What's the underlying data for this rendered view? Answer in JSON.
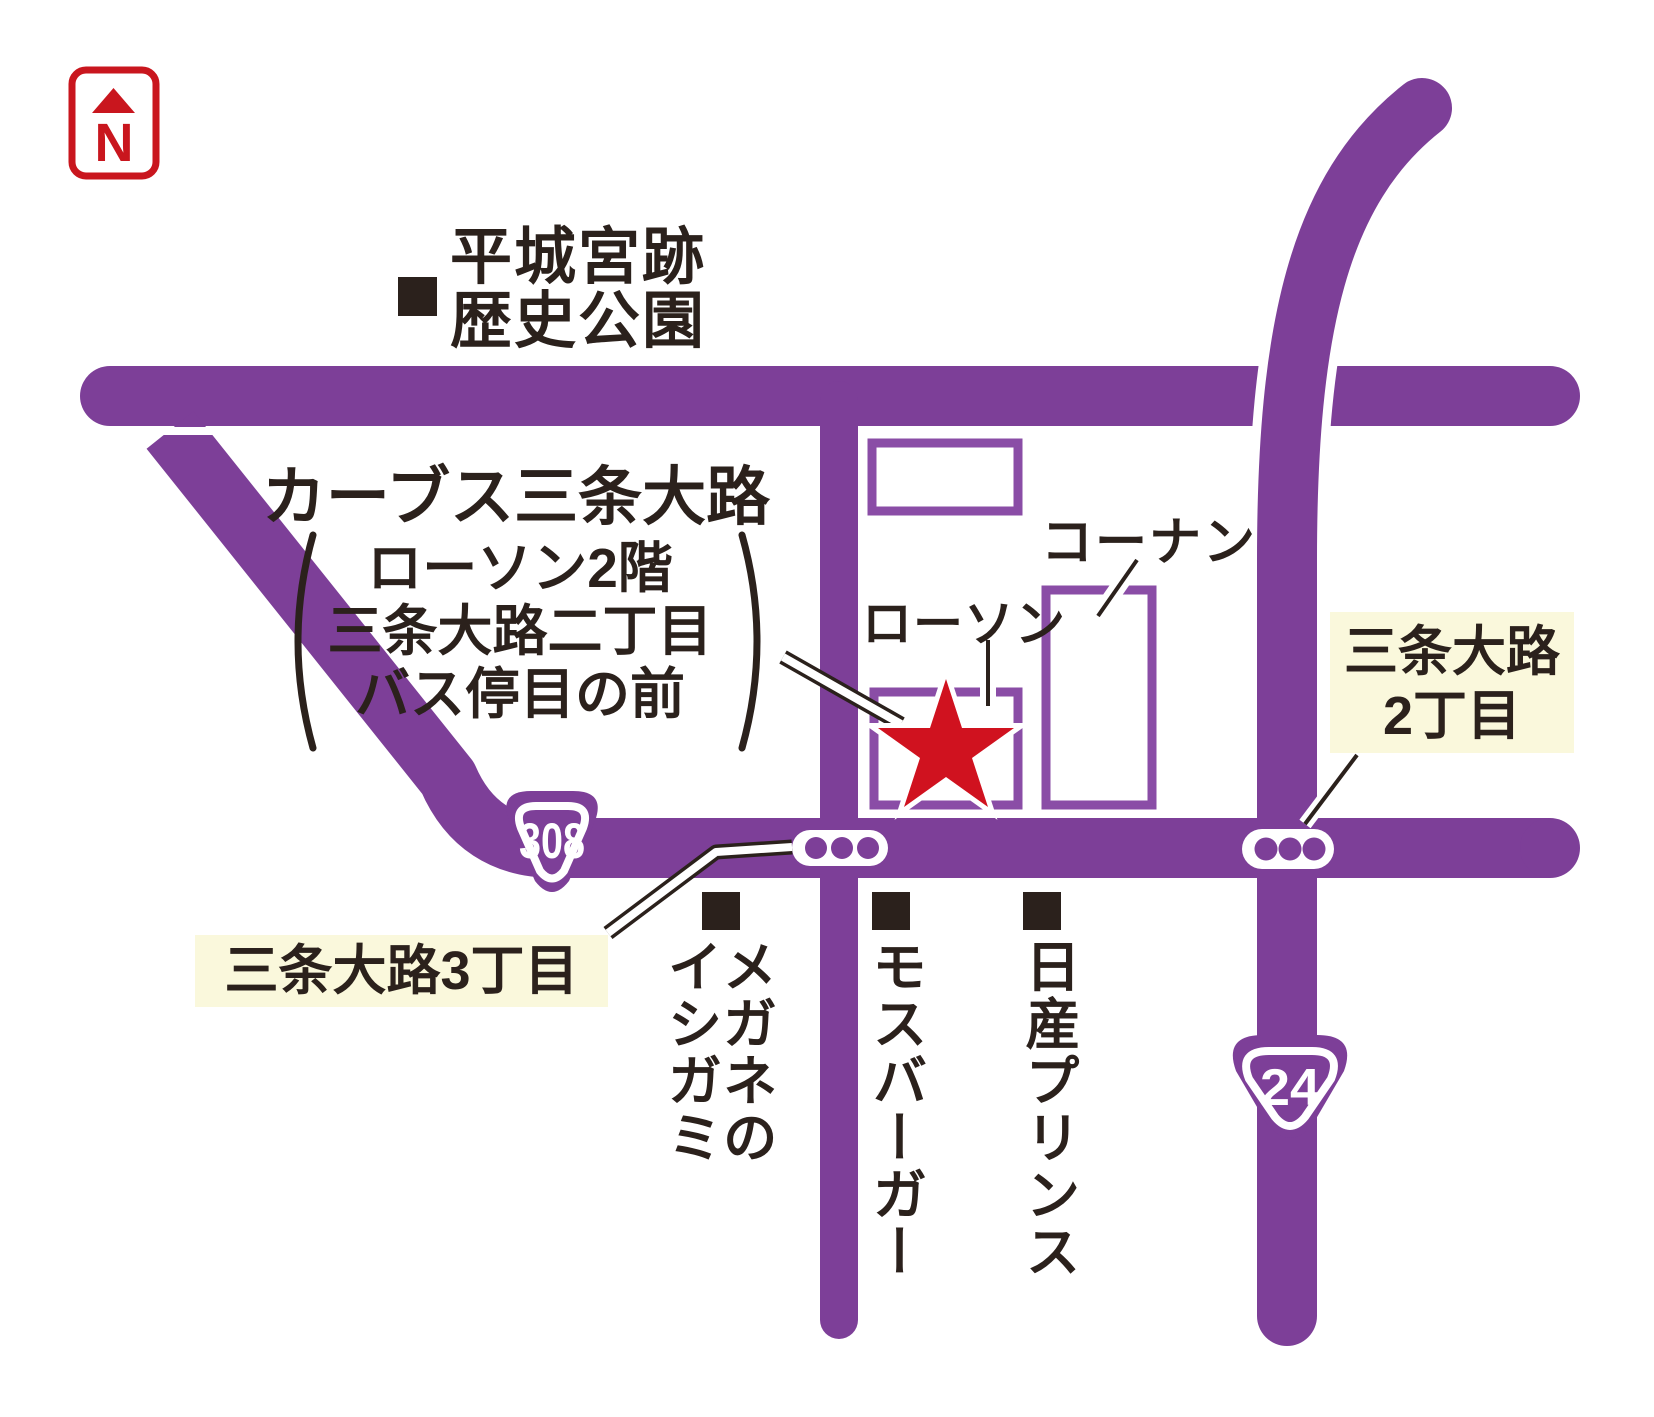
{
  "colors": {
    "road_purple": "#7d3f98",
    "building_outline": "#8a4da6",
    "star_red": "#d0121f",
    "north_red": "#c9161e",
    "text_dark": "#2b211c",
    "label_cream": "#faf8dc"
  },
  "north_indicator": {
    "letter": "N"
  },
  "title_block": {
    "title": "カーブス三条大路",
    "note_line1": "ローソン2階",
    "note_line2": "三条大路二丁目",
    "note_line3": "バス停目の前"
  },
  "landmarks": {
    "park": {
      "line1": "平城宮跡",
      "line2": "歴史公園"
    },
    "konan": "コーナン",
    "lawson": "ローソン",
    "megane": "メガネの\nイシガミ",
    "mos_burger": "モスバーガー",
    "nissan_prince": "日産プリンス"
  },
  "intersections": {
    "sanjo2": {
      "line1": "三条大路",
      "line2": "2丁目"
    },
    "sanjo3": "三条大路3丁目"
  },
  "route_shields": {
    "route308": "308",
    "route24": "24"
  }
}
